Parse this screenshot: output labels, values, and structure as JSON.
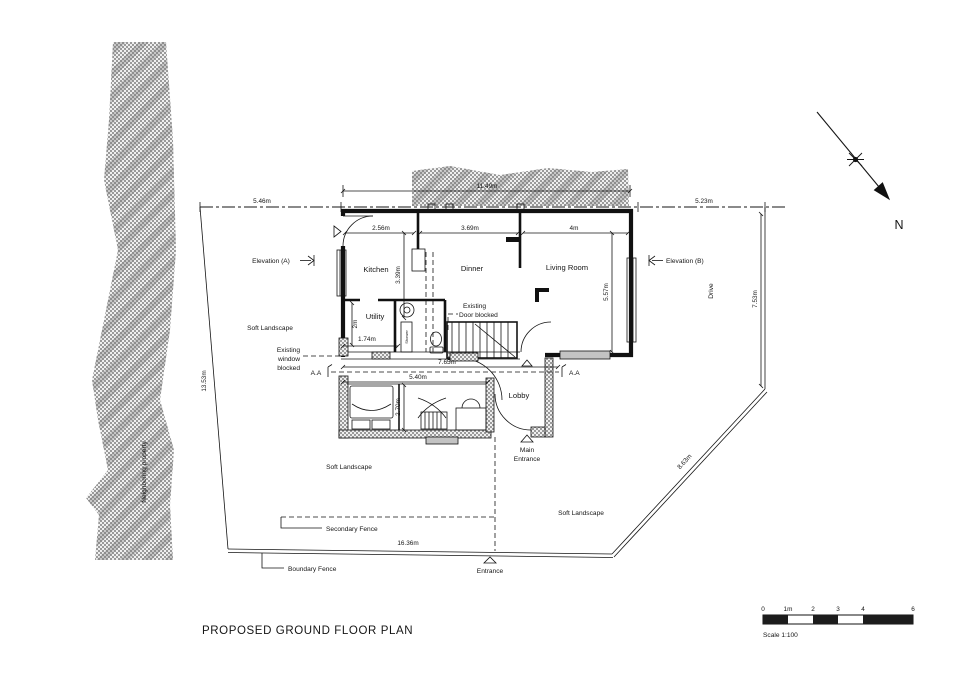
{
  "title": "PROPOSED  GROUND FLOOR PLAN",
  "north": {
    "label": "N"
  },
  "scalebar": {
    "ticks": [
      "0",
      "1m",
      "2",
      "3",
      "4",
      "6"
    ],
    "label": "Scale 1:100"
  },
  "site": {
    "neighboring_property": "Neighboring property",
    "drive": "Drive",
    "soft_landscape": "Soft Landscape",
    "boundary_fence": "Boundary Fence",
    "secondary_fence": "Secondary Fence",
    "entrance": "Entrance"
  },
  "rooms": {
    "kitchen": "Kitchen",
    "dinner": "Dinner",
    "living_room": "Living Room",
    "utility": "Utility",
    "lobby": "Lobby",
    "shower": "Shower"
  },
  "labels": {
    "elevation_a": "Elevation (A)",
    "elevation_b": "Elevation (B)",
    "existing_window_line1": "Existing",
    "existing_window_line2": "window",
    "existing_window_line3": "blocked",
    "existing_door_line1": "Existing",
    "existing_door_line2": "Door blocked",
    "main_entrance_line1": "Main",
    "main_entrance_line2": "Entrance",
    "section_aa": "A.A"
  },
  "dimensions": {
    "site_top_left": "5.46m",
    "house_top": "11.49m",
    "site_top_right": "5.23m",
    "site_left": "13.53m",
    "site_right": "7.53m",
    "site_diagonal": "8.63m",
    "site_bottom": "16.36m",
    "kitchen_width": "2.56m",
    "dinner_width": "3.69m",
    "living_width": "4m",
    "kitchen_depth": "3.39m",
    "living_depth": "5.57m",
    "utility_depth": "2m",
    "utility_width": "1.74m",
    "hall_width": "7.65m",
    "annex_width": "5.40m",
    "annex_depth": "2.70m"
  },
  "colors": {
    "line": "#151515",
    "hatch": "#9a9a9a",
    "background": "#ffffff"
  }
}
